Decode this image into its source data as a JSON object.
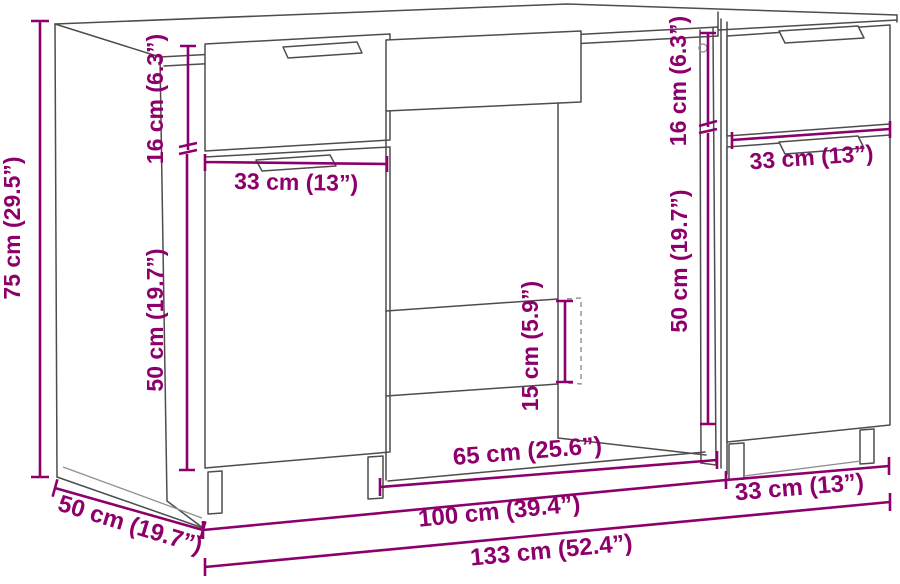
{
  "diagram": {
    "type": "furniture-dimension-diagram",
    "subject": "desk-with-side-cabinet",
    "accent_color": "#8d006c",
    "line_color": "#4d4d4d",
    "dims": {
      "height_total": {
        "label": "75 cm (29.5”)",
        "cm": 75,
        "inches": 29.5
      },
      "drawer_height_left": {
        "label": "16 cm (6.3”)",
        "cm": 16,
        "inches": 6.3
      },
      "door_height_left": {
        "label": "50 cm (19.7”)",
        "cm": 50,
        "inches": 19.7
      },
      "drawer_width_left": {
        "label": "33 cm (13”)",
        "cm": 33,
        "inches": 13
      },
      "drawer_height_right": {
        "label": "16 cm (6.3”)",
        "cm": 16,
        "inches": 6.3
      },
      "door_height_right": {
        "label": "50 cm (19.7”)",
        "cm": 50,
        "inches": 19.7
      },
      "cabinet_width_top": {
        "label": "33 cm (13”)",
        "cm": 33,
        "inches": 13
      },
      "bottom_clearance": {
        "label": "15 cm (5.9”)",
        "cm": 15,
        "inches": 5.9
      },
      "opening_width": {
        "label": "65 cm (25.6”)",
        "cm": 65,
        "inches": 25.6
      },
      "desk_width": {
        "label": "100 cm (39.4”)",
        "cm": 100,
        "inches": 39.4
      },
      "cabinet_width_bottom": {
        "label": "33 cm (13”)",
        "cm": 33,
        "inches": 13
      },
      "total_width": {
        "label": "133 cm (52.4”)",
        "cm": 133,
        "inches": 52.4
      },
      "depth": {
        "label": "50 cm (19.7”)",
        "cm": 50,
        "inches": 19.7
      }
    }
  }
}
